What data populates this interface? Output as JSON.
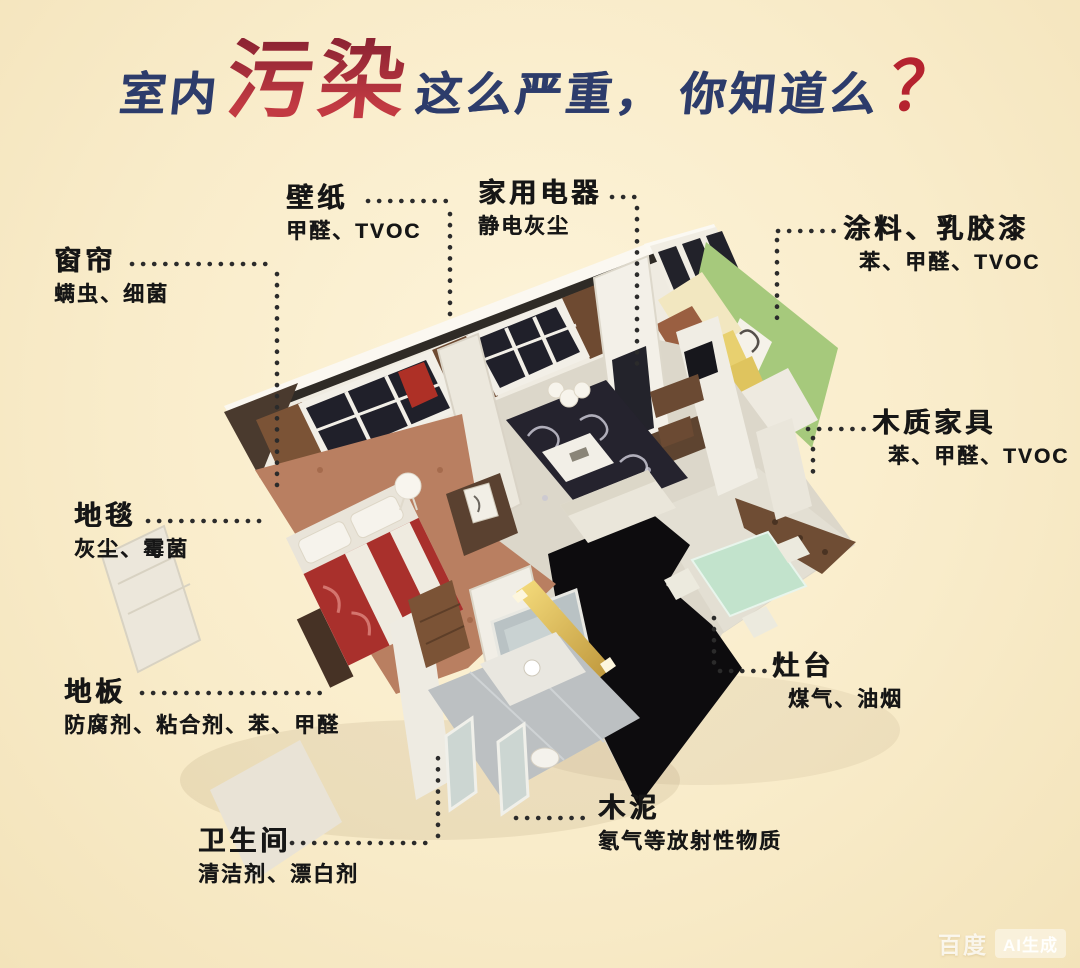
{
  "title": {
    "part1": "室内",
    "highlight": "污染",
    "part2": "这么严重，",
    "part3": "你知道么",
    "qmark": "？"
  },
  "callouts": [
    {
      "id": "wallpaper",
      "name": "壁纸",
      "pollutants": "甲醛、TVOC"
    },
    {
      "id": "appliance",
      "name": "家用电器",
      "pollutants": "静电灰尘"
    },
    {
      "id": "curtain",
      "name": "窗帘",
      "pollutants": "螨虫、细菌"
    },
    {
      "id": "paint",
      "name": "涂料、乳胶漆",
      "pollutants": "苯、甲醛、TVOC"
    },
    {
      "id": "furniture",
      "name": "木质家具",
      "pollutants": "苯、甲醛、TVOC"
    },
    {
      "id": "carpet",
      "name": "地毯",
      "pollutants": "灰尘、霉菌"
    },
    {
      "id": "stove",
      "name": "灶台",
      "pollutants": "煤气、油烟"
    },
    {
      "id": "floor",
      "name": "地板",
      "pollutants": "防腐剂、粘合剂、苯、甲醛"
    },
    {
      "id": "bathroom",
      "name": "卫生间",
      "pollutants": "清洁剂、漂白剂"
    },
    {
      "id": "cement",
      "name": "木泥",
      "pollutants": "氡气等放射性物质"
    }
  ],
  "watermark": {
    "brand": "百度",
    "badge": "AI生成"
  },
  "colors": {
    "background": "#f9ecca",
    "title_blue": "#2d3c6b",
    "title_red": "#b23038",
    "label_text": "#161616",
    "leader_dot": "#2b2b2b",
    "green_wall": "#a6c97c",
    "bedroom_floor": "#b97f61",
    "bed_red": "#a9302c",
    "black_floor": "#0d0c0e",
    "dining_mint": "#c2e3cc",
    "light_bar_gold": "#e9c85e"
  }
}
